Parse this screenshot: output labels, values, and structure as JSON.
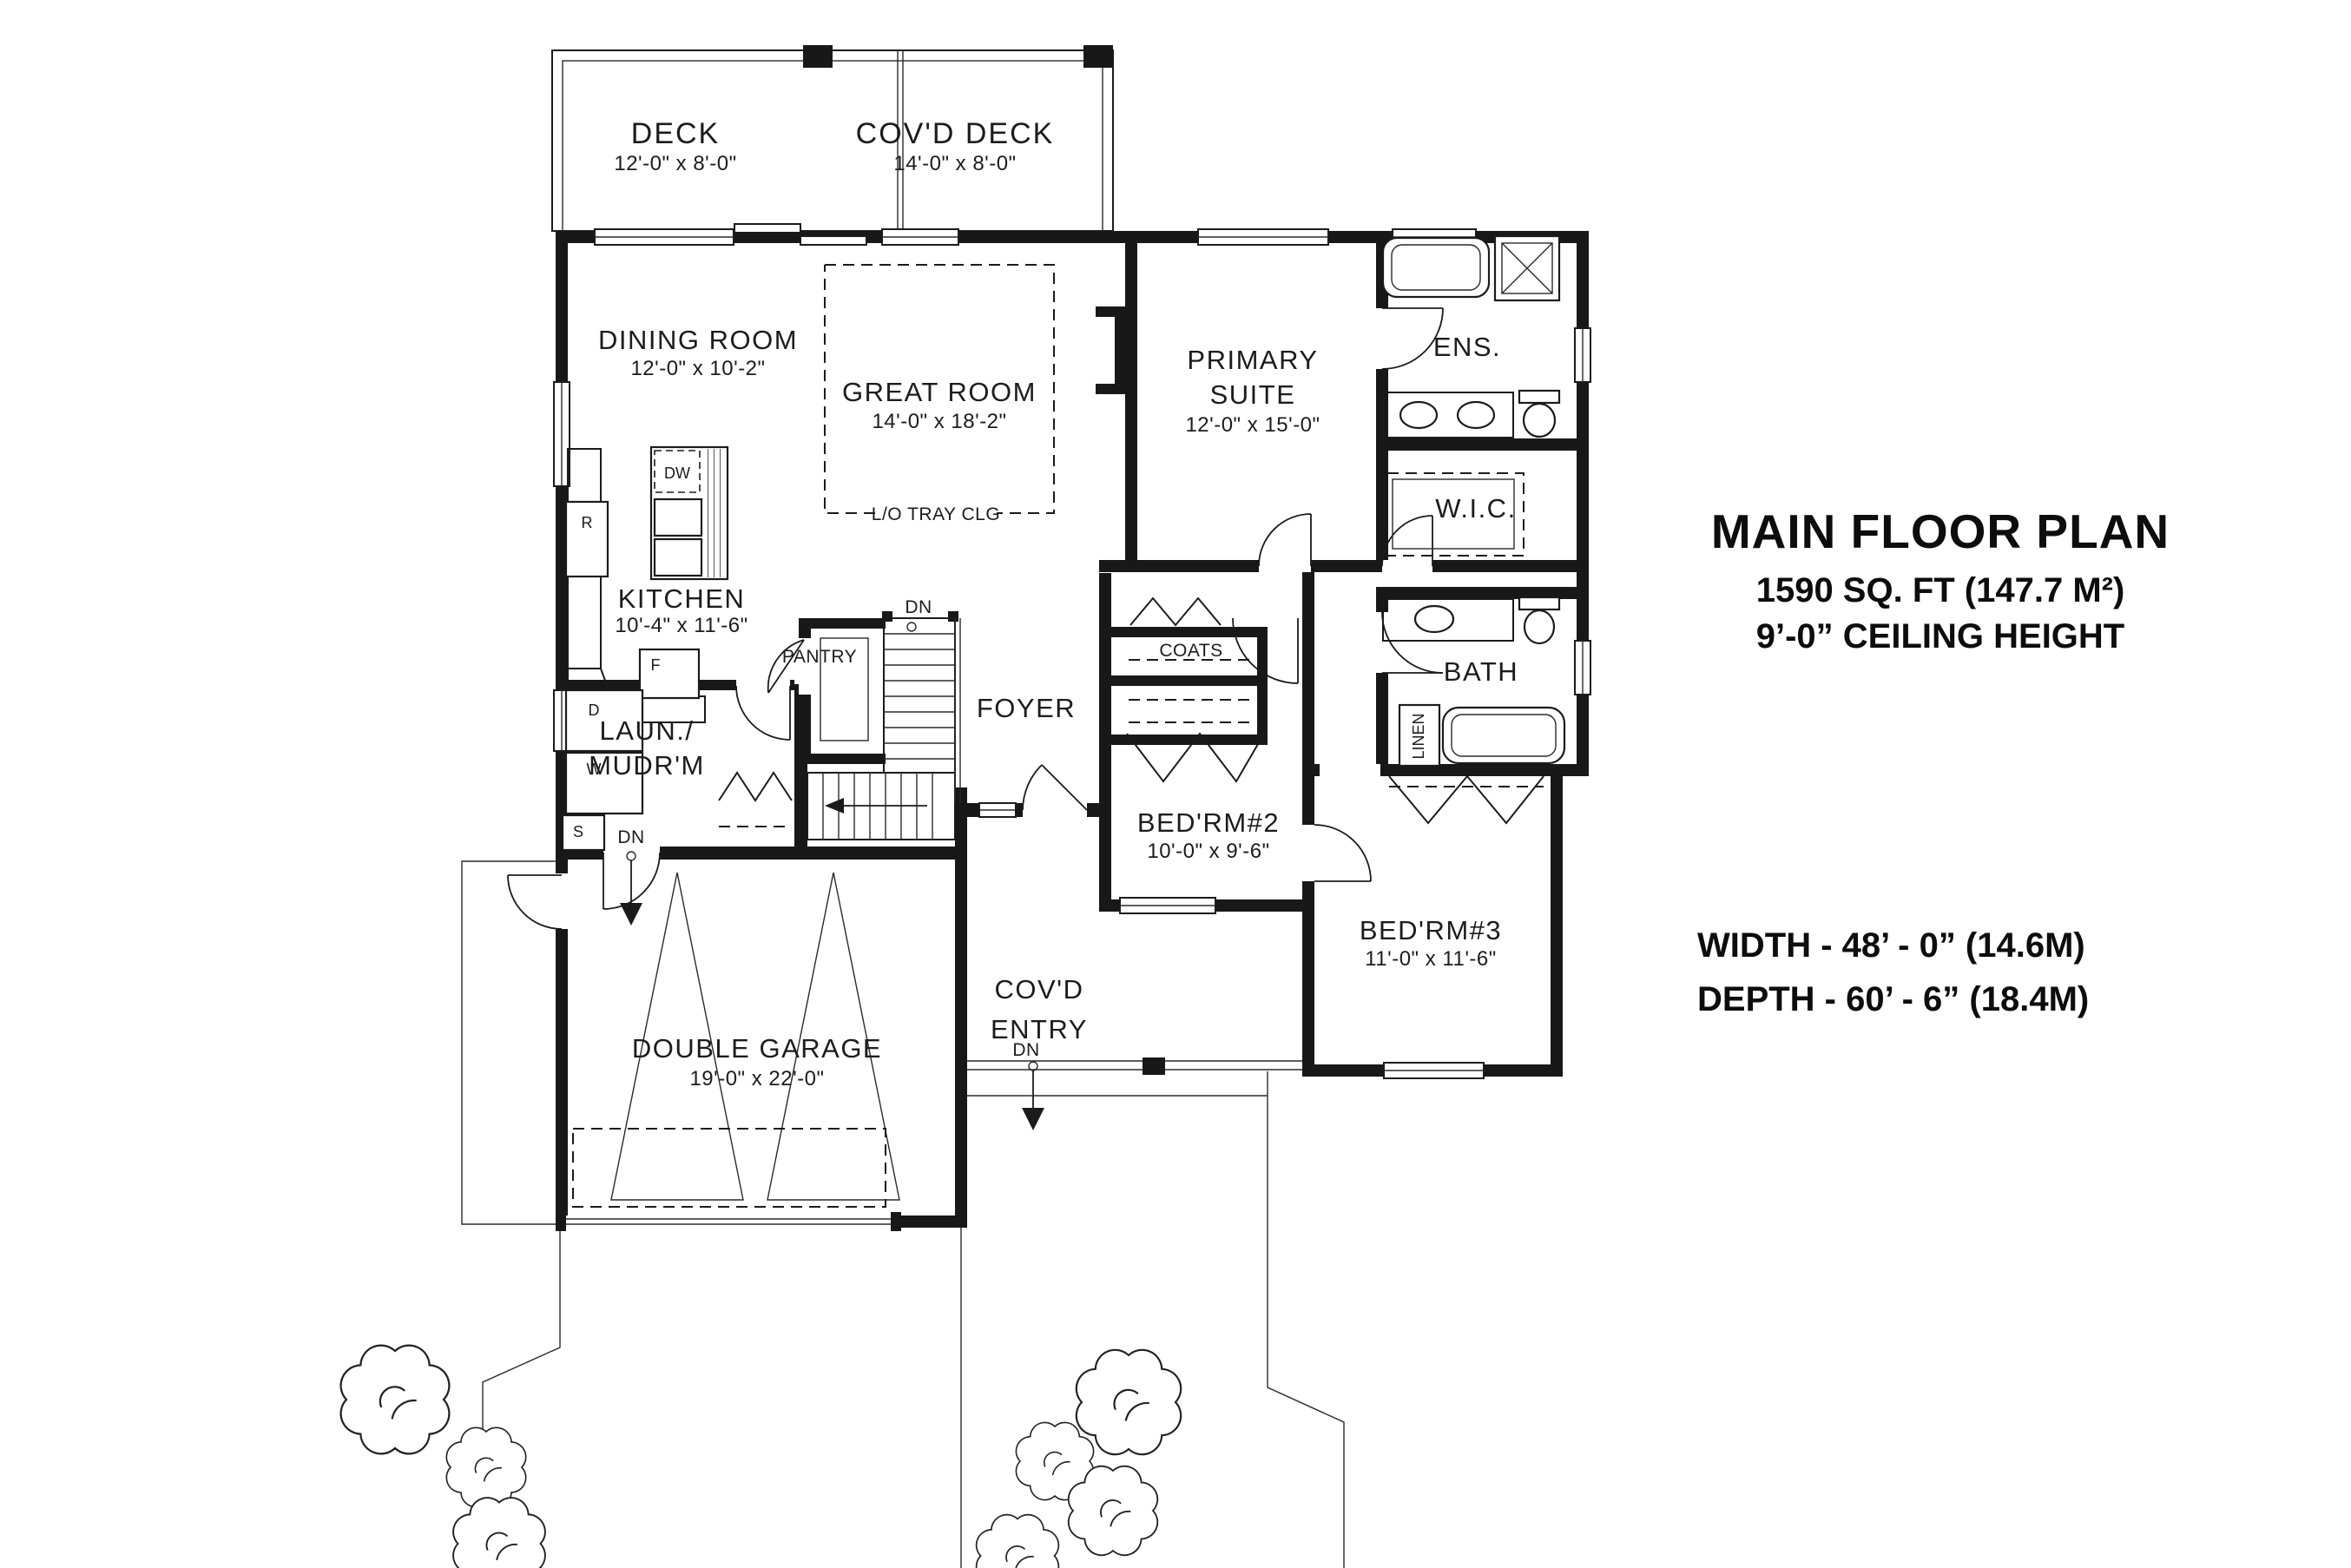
{
  "title_block": {
    "title": "MAIN FLOOR PLAN",
    "area": "1590 SQ. FT (147.7 M²)",
    "ceiling": "9’-0” CEILING HEIGHT"
  },
  "size_block": {
    "width": "WIDTH - 48’ - 0” (14.6M)",
    "depth": "DEPTH - 60’ - 6” (18.4M)"
  },
  "rooms": {
    "deck": {
      "name": "DECK",
      "dims": "12'-0\" x 8'-0\""
    },
    "covd_deck": {
      "name": "COV'D DECK",
      "dims": "14'-0\" x 8'-0\""
    },
    "dining": {
      "name": "DINING ROOM",
      "dims": "12'-0\" x 10'-2\""
    },
    "great": {
      "name": "GREAT ROOM",
      "dims": "14'-0\" x 18'-2\"",
      "ceiling_note": "L/O TRAY CLG"
    },
    "primary": {
      "line1": "PRIMARY",
      "line2": "SUITE",
      "dims": "12'-0\" x 15'-0\""
    },
    "ensuite": {
      "name": "ENS."
    },
    "wic": {
      "name": "W.I.C."
    },
    "kitchen": {
      "name": "KITCHEN",
      "dims": "10'-4\" x 11'-6\""
    },
    "pantry": {
      "name": "PANTRY"
    },
    "laundry": {
      "line1": "LAUN./",
      "line2": "MUDR'M"
    },
    "foyer": {
      "name": "FOYER"
    },
    "coats": {
      "name": "COATS"
    },
    "bath": {
      "name": "BATH"
    },
    "linen": {
      "name": "LINEN"
    },
    "bedroom2": {
      "name": "BED'RM#2",
      "dims": "10'-0\" x 9'-6\""
    },
    "bedroom3": {
      "name": "BED'RM#3",
      "dims": "11'-0\" x 11'-6\""
    },
    "garage": {
      "name": "DOUBLE GARAGE",
      "dims": "19'-0\" x 22'-0\""
    },
    "covd_entry": {
      "line1": "COV'D",
      "line2": "ENTRY"
    }
  },
  "annotations": {
    "down": "DN",
    "dishwasher": "DW",
    "range": "R",
    "fridge": "F",
    "dryer": "D",
    "washer": "W",
    "sink": "S"
  },
  "colors": {
    "ink": "#1a1a1a",
    "background": "#ffffff"
  }
}
